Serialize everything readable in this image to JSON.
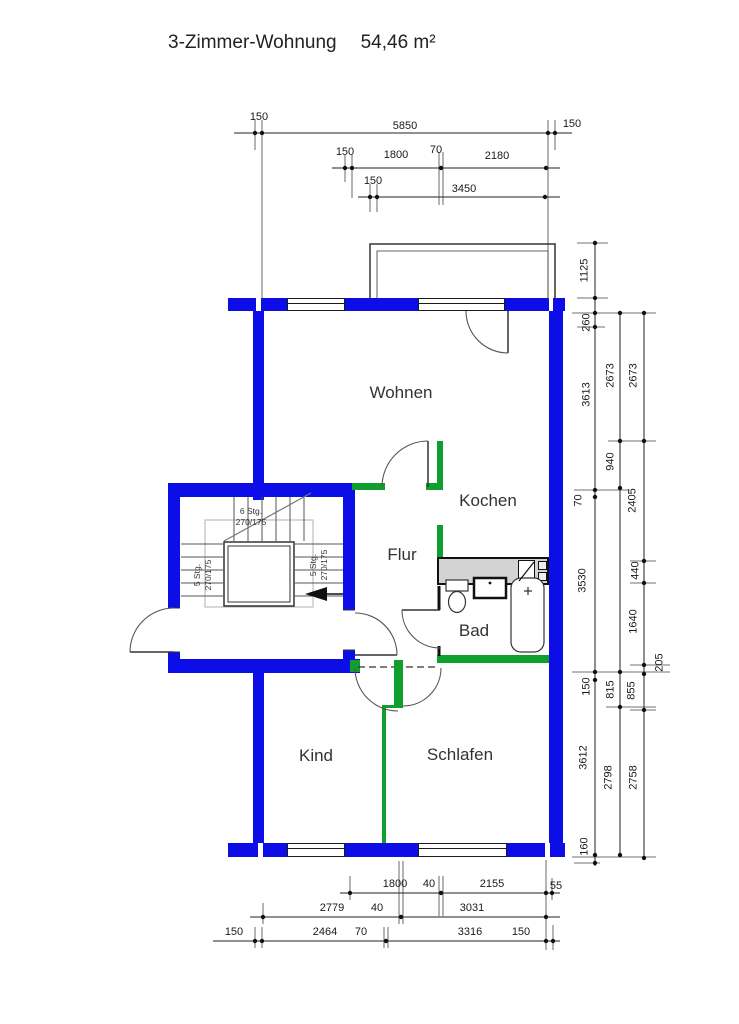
{
  "title": {
    "text": "3-Zimmer-Wohnung",
    "area": "54,46 m²"
  },
  "rooms": {
    "wohnen": "Wohnen",
    "kochen": "Kochen",
    "flur": "Flur",
    "bad": "Bad",
    "kind": "Kind",
    "schlafen": "Schlafen"
  },
  "stairwell": {
    "flight_top_line1": "6 Stg.",
    "flight_top_line2": "270/175",
    "flight_left_line1": "5 Stg.",
    "flight_left_line2": "270/175",
    "flight_right_line1": "5 Stg.",
    "flight_right_line2": "270/175"
  },
  "dimensions": {
    "top": [
      "150",
      "5850",
      "150",
      "150",
      "1800",
      "70",
      "2180",
      "150",
      "3450"
    ],
    "right": [
      "1125",
      "260",
      "2673",
      "2673",
      "3613",
      "940",
      "70",
      "2405",
      "3530",
      "440",
      "1640",
      "205",
      "150",
      "815",
      "855",
      "3612",
      "2798",
      "2758",
      "160"
    ],
    "bottom": [
      "1800",
      "40",
      "2155",
      "55",
      "2779",
      "40",
      "3031",
      "150",
      "2464",
      "70",
      "3316",
      "150"
    ]
  },
  "colors": {
    "wall": "#0d0de8",
    "partition": "#0f9f2f",
    "counter": "#d3d3d3"
  }
}
